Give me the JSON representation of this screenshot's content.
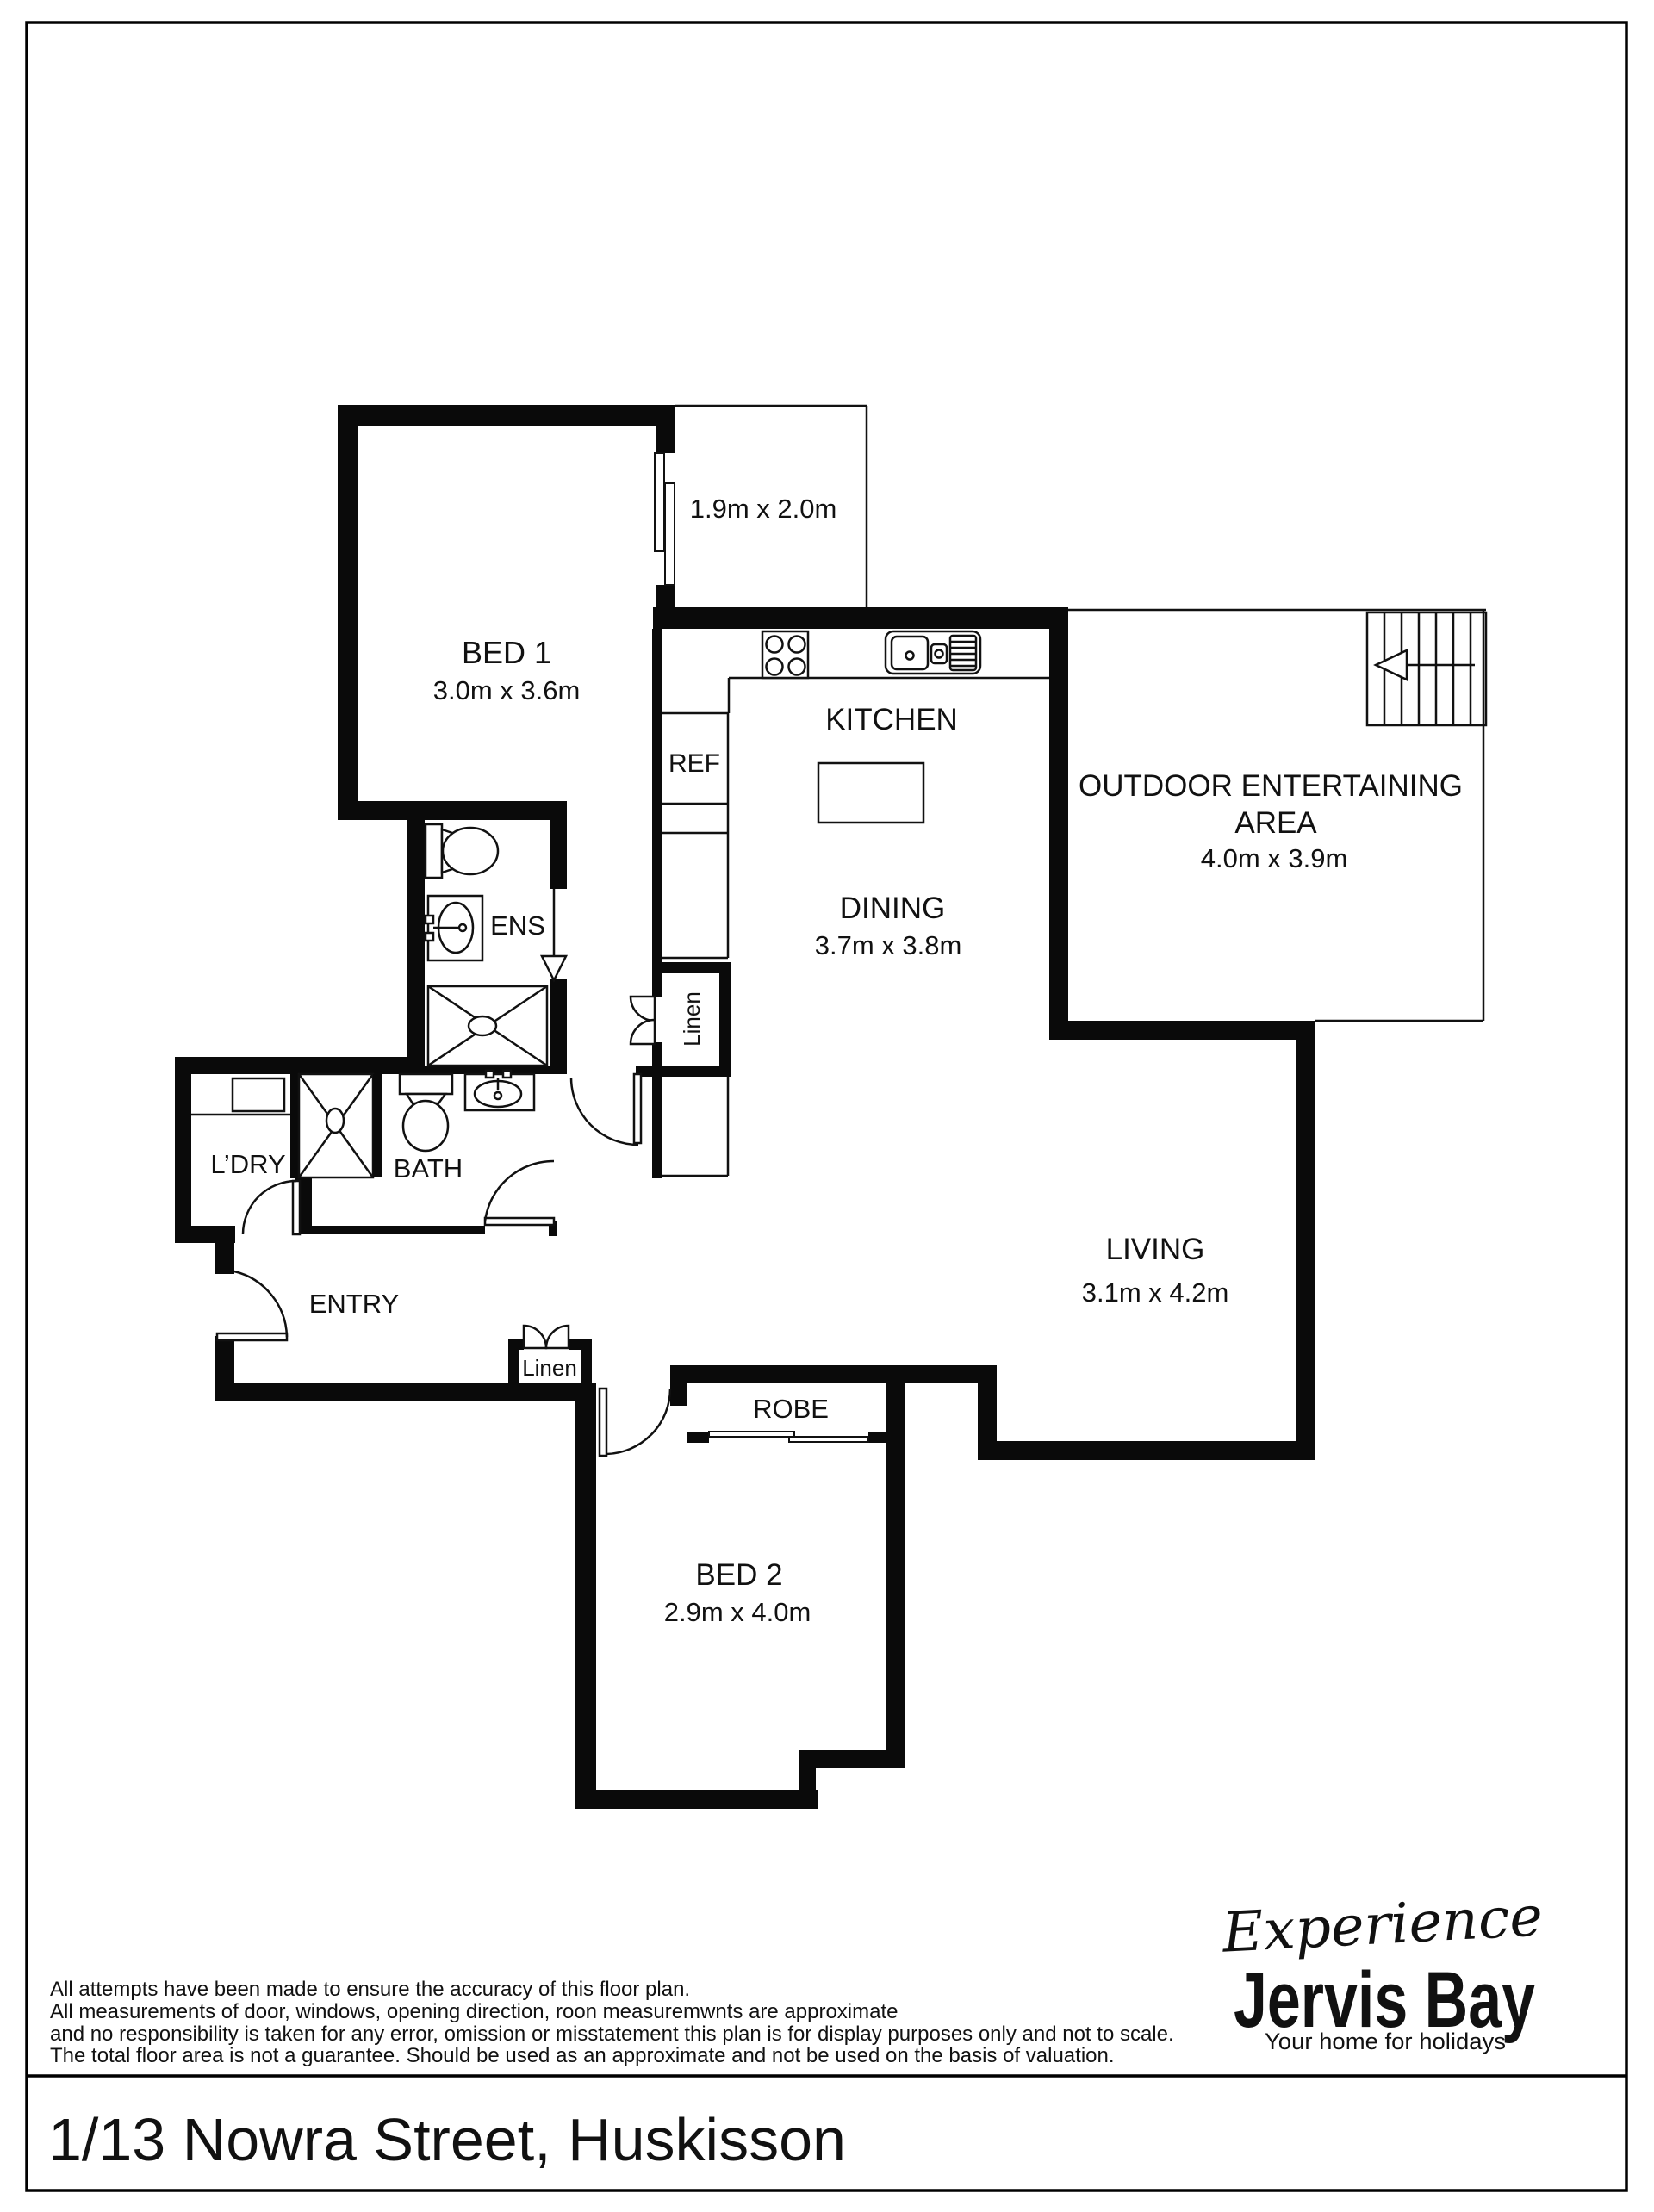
{
  "colors": {
    "walls": "#0a0a0a",
    "thin_lines": "#111111",
    "logo": "#333e47",
    "background": "#ffffff"
  },
  "floor_plan": {
    "rooms": {
      "bed1": {
        "name": "BED 1",
        "dims": "3.0m x 3.6m"
      },
      "store": {
        "dims": "1.9m x 2.0m"
      },
      "kitchen": {
        "name": "KITCHEN"
      },
      "ref": {
        "name": "REF"
      },
      "dining": {
        "name": "DINING",
        "dims": "3.7m x 3.8m"
      },
      "outdoor": {
        "name": "OUTDOOR ENTERTAINING",
        "name2": "AREA",
        "dims": "4.0m x 3.9m"
      },
      "living": {
        "name": "LIVING",
        "dims": "3.1m x 4.2m"
      },
      "ens": {
        "name": "ENS"
      },
      "bath": {
        "name": "BATH"
      },
      "ldry": {
        "name": "L’DRY"
      },
      "entry": {
        "name": "ENTRY"
      },
      "linen_hall": {
        "name": "Linen"
      },
      "linen_entry": {
        "name": "Linen"
      },
      "robe": {
        "name": "ROBE"
      },
      "bed2": {
        "name": "BED 2",
        "dims": "2.9m x 4.0m"
      }
    },
    "icons": {
      "stove": "stove-cooktop-icon",
      "sink": "double-sink-icon",
      "island": "kitchen-island-icon",
      "fridge_bay": "fridge-pantry-icon",
      "ens_toilet": "toilet-icon",
      "ens_vanity": "vanity-basin-icon",
      "ens_shower": "shower-icon",
      "bath_toilet": "toilet-icon",
      "bath_vanity": "vanity-basin-icon",
      "bath_shower": "shower-icon",
      "washer": "laundry-tub-icon",
      "stairs": "stairs-up-arrow-icon",
      "door": "door-swing-icon",
      "window": "window-icon",
      "ens_entry_arrow": "entry-direction-arrow-icon"
    }
  },
  "disclaimer": {
    "lines": [
      "All attempts have been made to ensure the accuracy of this floor plan.",
      "All measurements of door, windows, opening direction, roon measuremwnts are approximate",
      "and no responsibility is taken for any error, omission or misstatement this plan is for display purposes only and not to scale.",
      "The total floor area is not a guarantee. Should be used as an approximate and not be used on the basis of valuation."
    ]
  },
  "logo": {
    "script": "Experience",
    "brand": "Jervis Bay",
    "tagline": "Your home for holidays"
  },
  "footer": {
    "address": "1/13 Nowra Street, Huskisson"
  }
}
